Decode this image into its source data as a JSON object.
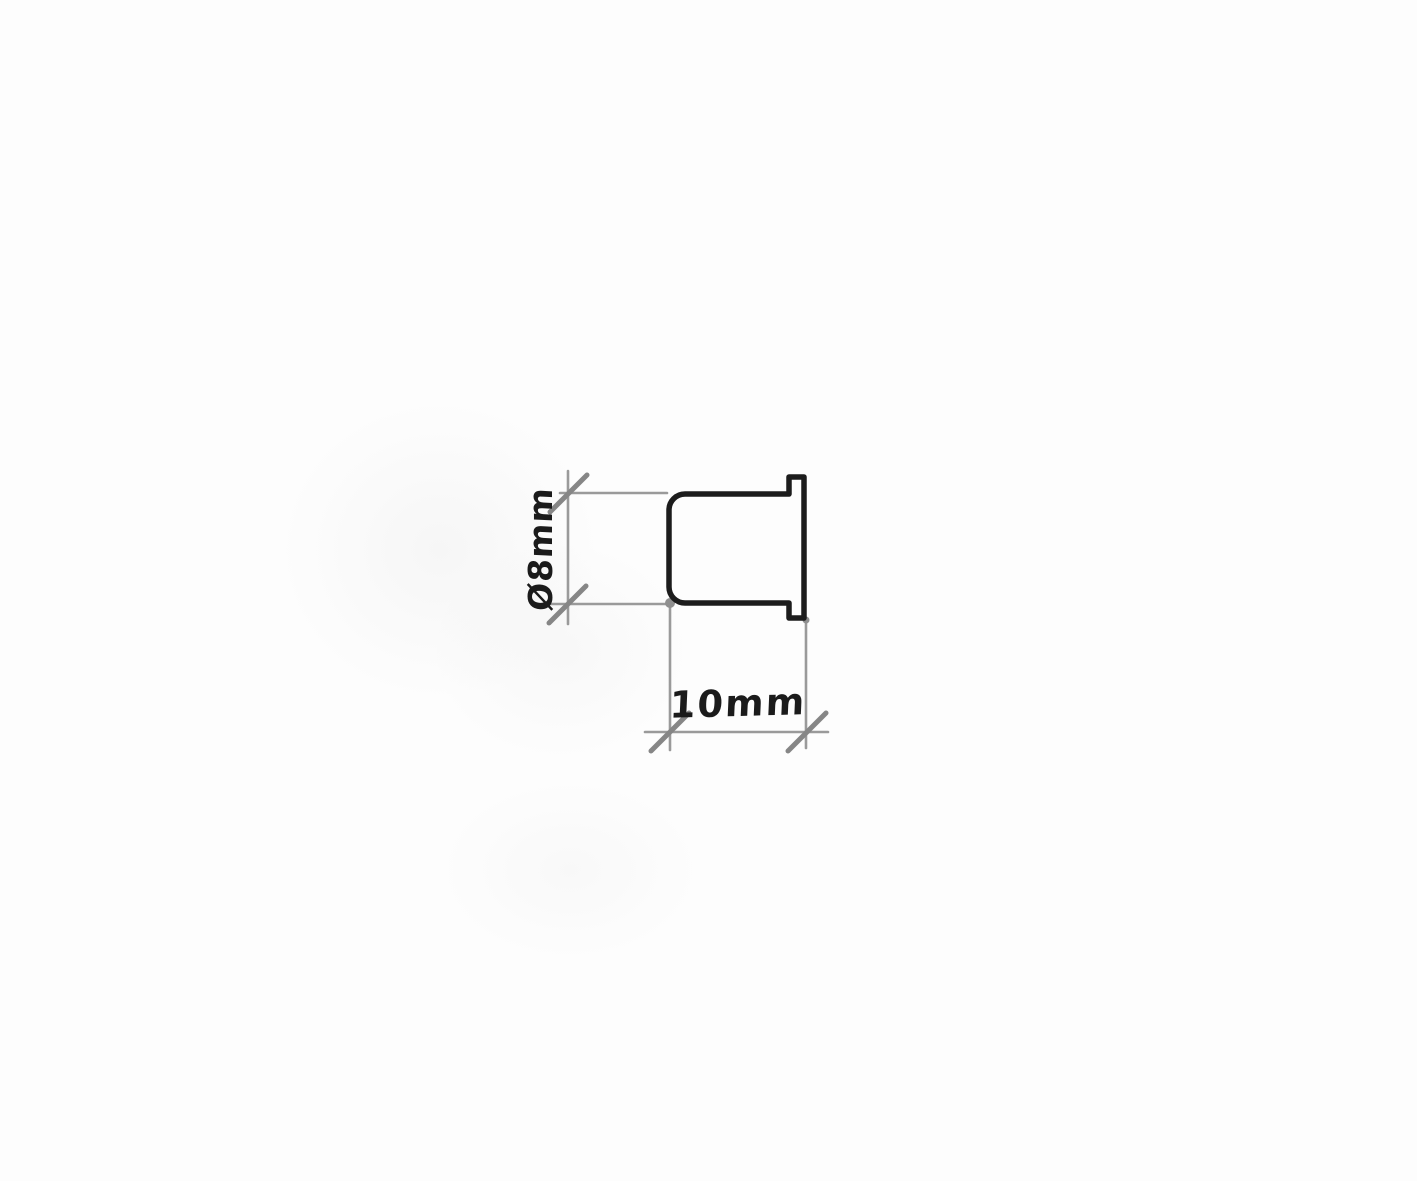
{
  "sketch": {
    "kind": "hand-drawn technical sketch",
    "colors": {
      "paper": "#fdfdfd",
      "outline": "#1c1c1c",
      "dimension_line": "#9a9a9a",
      "tick": "#868686",
      "junction_dot": "#8f8f8f",
      "label_text": "#1b1b1b"
    },
    "dimensions": {
      "diameter": {
        "label": "Ø8mm",
        "symbol": "Ø",
        "value": 8,
        "unit": "mm",
        "orientation": "vertical"
      },
      "length": {
        "label": "10mm",
        "value": 10,
        "unit": "mm",
        "orientation": "horizontal"
      }
    }
  }
}
